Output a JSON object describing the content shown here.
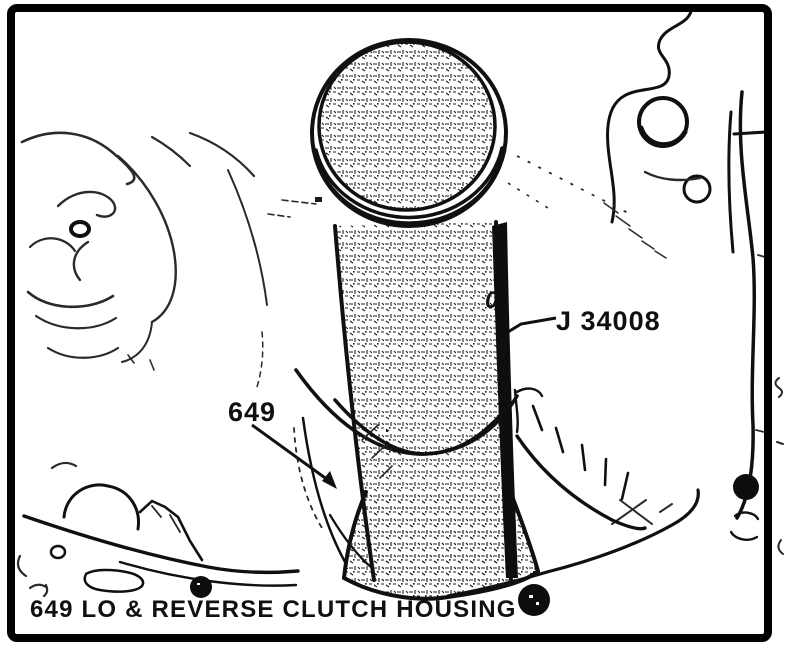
{
  "figure": {
    "labels": {
      "tool": "J 34008",
      "part": "649",
      "marking": "0",
      "caption": "649 LO & REVERSE CLUTCH HOUSING"
    },
    "colors": {
      "ink": "#101010",
      "paper": "#ffffff"
    }
  }
}
